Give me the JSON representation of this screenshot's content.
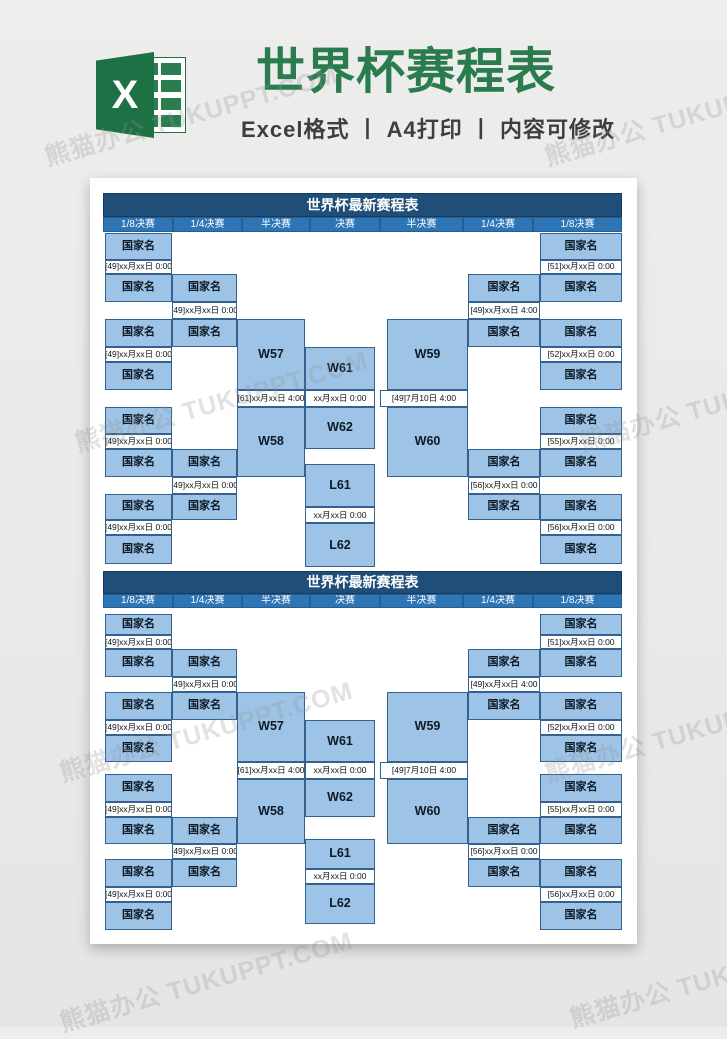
{
  "banner": {
    "logo_letter": "X",
    "title": "世界杯赛程表",
    "subtitle": "Excel格式 丨 A4打印 丨 内容可修改"
  },
  "watermark": {
    "text": "熊猫办公 TUKUPPT.COM"
  },
  "tables": [
    {
      "title": "世界杯最新赛程表",
      "round_headers": [
        "1/8决赛",
        "1/4决赛",
        "半决赛",
        "决赛",
        "半决赛",
        "1/4决赛",
        "1/8决赛"
      ],
      "team_placeholder": "国家名",
      "round16_left_dates": [
        "[49]xx月xx日 0:00",
        "[49]xx月xx日 0:00",
        "[49]xx月xx日 0:00",
        "[49]xx月xx日 0:00"
      ],
      "quarter_left_dates": [
        "[49]xx月xx日 0:00",
        "[49]xx月xx日 0:00"
      ],
      "semi_left": {
        "top": "W57",
        "date": "[61]xx月xx日 4:00",
        "bottom": "W58"
      },
      "final": {
        "top": "W61",
        "date": "xx月xx日 0:00",
        "bottom": "W62"
      },
      "third_place": {
        "top": "L61",
        "date": "xx月xx日 0:00",
        "bottom": "L62"
      },
      "semi_right": {
        "top": "W59",
        "date": "[49]7月10日 4:00",
        "bottom": "W60"
      },
      "quarter_right_dates": [
        "[49]xx月xx日 4:00",
        "[56]xx月xx日 0:00"
      ],
      "round16_right_dates": [
        "[51]xx月xx日 0:00",
        "[52]xx月xx日 0:00",
        "[55]xx月xx日 0:00",
        "[56]xx月xx日 0:00"
      ]
    },
    {
      "title": "世界杯最新赛程表",
      "round_headers": [
        "1/8决赛",
        "1/4决赛",
        "半决赛",
        "决赛",
        "半决赛",
        "1/4决赛",
        "1/8决赛"
      ],
      "team_placeholder": "国家名",
      "round16_left_dates": [
        "[49]xx月xx日 0:00",
        "[49]xx月xx日 0:00",
        "[49]xx月xx日 0:00",
        "[49]xx月xx日 0:00"
      ],
      "quarter_left_dates": [
        "[49]xx月xx日 0:00",
        "[49]xx月xx日 0:00"
      ],
      "semi_left": {
        "top": "W57",
        "date": "[61]xx月xx日 4:00",
        "bottom": "W58"
      },
      "final": {
        "top": "W61",
        "date": "xx月xx日 0:00",
        "bottom": "W62"
      },
      "third_place": {
        "top": "L61",
        "date": "xx月xx日 0:00",
        "bottom": "L62"
      },
      "semi_right": {
        "top": "W59",
        "date": "[49]7月10日 4:00",
        "bottom": "W60"
      },
      "quarter_right_dates": [
        "[49]xx月xx日 4:00",
        "[56]xx月xx日 0:00"
      ],
      "round16_right_dates": [
        "[51]xx月xx日 0:00",
        "[52]xx月xx日 0:00",
        "[55]xx月xx日 0:00",
        "[56]xx月xx日 0:00"
      ]
    }
  ],
  "colors": {
    "excel_green": "#1e7145",
    "logo_sheet_green": "#2a7d4f",
    "title_green": "#2a7c4f",
    "subtitle_gray": "#3e3e3e",
    "table_title_bg": "#1f4e79",
    "round_header_bg": "#2e75b6",
    "cell_fill": "#9dc3e6",
    "cell_border": "#35618f",
    "date_fill": "#fdfeff",
    "page_bg": "#ffffff"
  }
}
